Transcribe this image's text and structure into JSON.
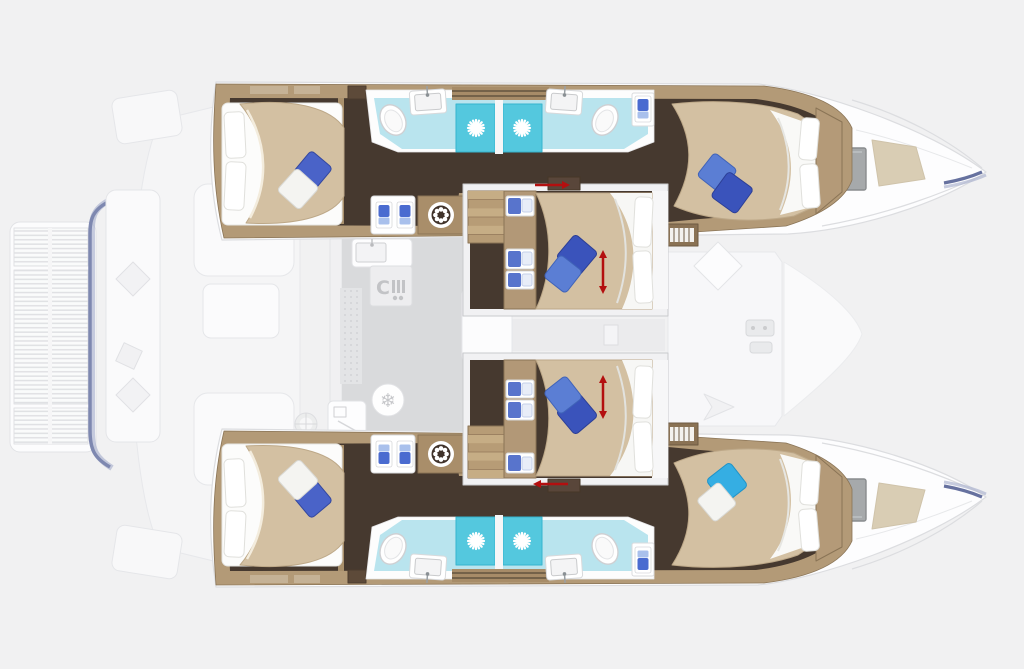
{
  "page": {
    "title": "Catamaran accommodation floor plan — top-down view, bow to the right",
    "view": "top-down deck and cabin layout",
    "orientation": "bow-right"
  },
  "palette": {
    "background": "#f1f1f2",
    "ghost_deck": "#f8f8f9",
    "ghost_stroke": "#e4e5e8",
    "saloon_floor": "#d9dadc",
    "floor_dark_wood": "#46392f",
    "trim_wood": "#b39a77",
    "bed_linen_beige": "#d3c0a2",
    "bathroom_floor_cyan": "#b9e4ee",
    "shower_floor_cyan": "#54c8de",
    "pillow_dark_blue": "#3a53bb",
    "pillow_medium_blue": "#5b7ed4",
    "pillow_aft_blue": "#4a63c8",
    "pillow_light_blue": "#35aee3",
    "accent_red": "#b30f0f",
    "bow_window_gray": "#a6a9ab",
    "bow_sunpad": "#d9cdb4",
    "hull_accent_blue": "#66719f"
  },
  "icons": {
    "stove_glyph": "C",
    "snowflake_glyph": "❄",
    "list": [
      "ship-wheel-icon",
      "shower-drain-icon",
      "wardrobe-shirt-icon",
      "toilet-icon",
      "sink-icon",
      "snowflake-icon",
      "stove-icon",
      "windlass-icon",
      "stairs-icon",
      "convertible-arrow-icon"
    ]
  },
  "layout": {
    "hulls": [
      {
        "name": "port hull (top)",
        "rooms": [
          "aft double cabin with island bed",
          "aft bathroom: sink, toilet, shower",
          "forward bathroom: sink, toilet, shower",
          "forward double cabin"
        ],
        "fixtures": [
          "wardrobe with hanging clothes",
          "ship-wheel locker",
          "companionway stairs",
          "bow deck hatch window",
          "bow sun pad"
        ]
      },
      {
        "name": "starboard hull (bottom)",
        "rooms": [
          "aft double cabin with island bed",
          "aft bathroom: sink, toilet, shower",
          "forward bathroom: sink, toilet, shower",
          "forward double cabin"
        ],
        "fixtures": [
          "wardrobe with hanging clothes",
          "ship-wheel locker",
          "companionway stairs",
          "bow deck hatch window",
          "bow sun pad"
        ]
      }
    ],
    "center": {
      "cabins": [
        {
          "name": "center cabin forward-top",
          "features": [
            "double bed with two blue pillows",
            "storage drawer column",
            "entry stairs",
            "sliding door with red arrow",
            "red double arrow (convertible berth)"
          ]
        },
        {
          "name": "center cabin forward-bottom",
          "features": [
            "double bed with two blue pillows",
            "storage drawer column",
            "entry stairs",
            "sliding door with red arrow",
            "red double arrow (convertible berth)"
          ]
        }
      ],
      "saloon": {
        "galley": [
          "sink counter",
          "stove",
          "fridge (snowflake)",
          "appliance"
        ],
        "furniture": [
          "saloon table",
          "sliding door wall",
          "helm ghost wheel"
        ]
      },
      "cockpit": [
        "bench seating",
        "cockpit tables",
        "transom steps"
      ],
      "stern_platform": "slatted swim / davit platform",
      "foredeck": [
        "locker hatch (diamond)",
        "direction chevron",
        "anchor windlass",
        "forepeak deck"
      ]
    },
    "totals": {
      "cabins": 6,
      "wet_rooms": 4,
      "showers": 4,
      "toilets": 4,
      "sinks": 4
    }
  }
}
